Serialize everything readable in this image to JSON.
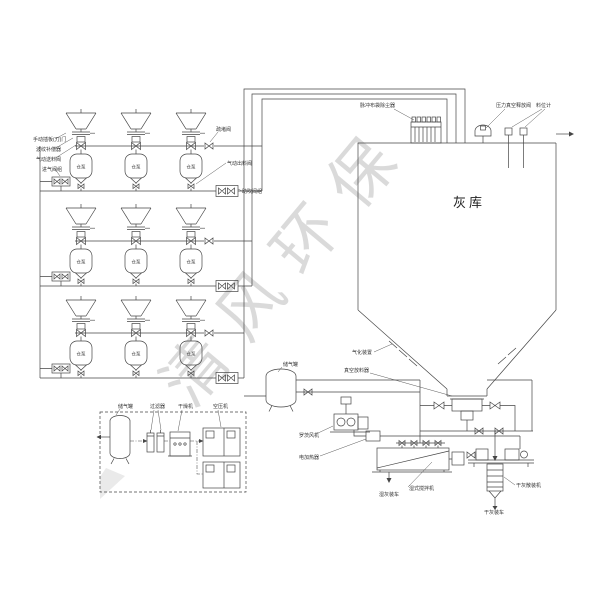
{
  "watermark": "清风环保",
  "silo": {
    "label": "灰库"
  },
  "pump": "仓泵",
  "labels": {
    "manual_gate": "手动插板(刀)门",
    "bellows": "波纹补偿器",
    "feed_valve": "气动送料阀",
    "inlet_valve_group": "进气阀组",
    "unblock_valve": "疏堵阀",
    "discharge_valve": "气动出料阀",
    "assist_blow_group": "助吹阀组",
    "dust_collector": "脉冲布袋除尘器",
    "pressure_vacuum_valve": "压力真空释放阀",
    "level_gauge": "料位计",
    "fluidizer": "气化装置",
    "vacuum_discharger": "真空放料器",
    "roots_blower": "罗茨风机",
    "electric_heater": "电加热器",
    "wet_mixer": "湿式搅拌机",
    "wet_ash_truck": "湿灰装车",
    "dry_ash_loader": "干灰散装机",
    "dry_ash_truck": "干灰装车",
    "air_tank": "储气罐",
    "filter": "过滤器",
    "dryer": "干燥机",
    "air_compressor": "空压机",
    "mid_air_tank": "储气罐"
  },
  "colors": {
    "line": "#454545",
    "label": "#333333",
    "watermark": "#dddddd"
  }
}
